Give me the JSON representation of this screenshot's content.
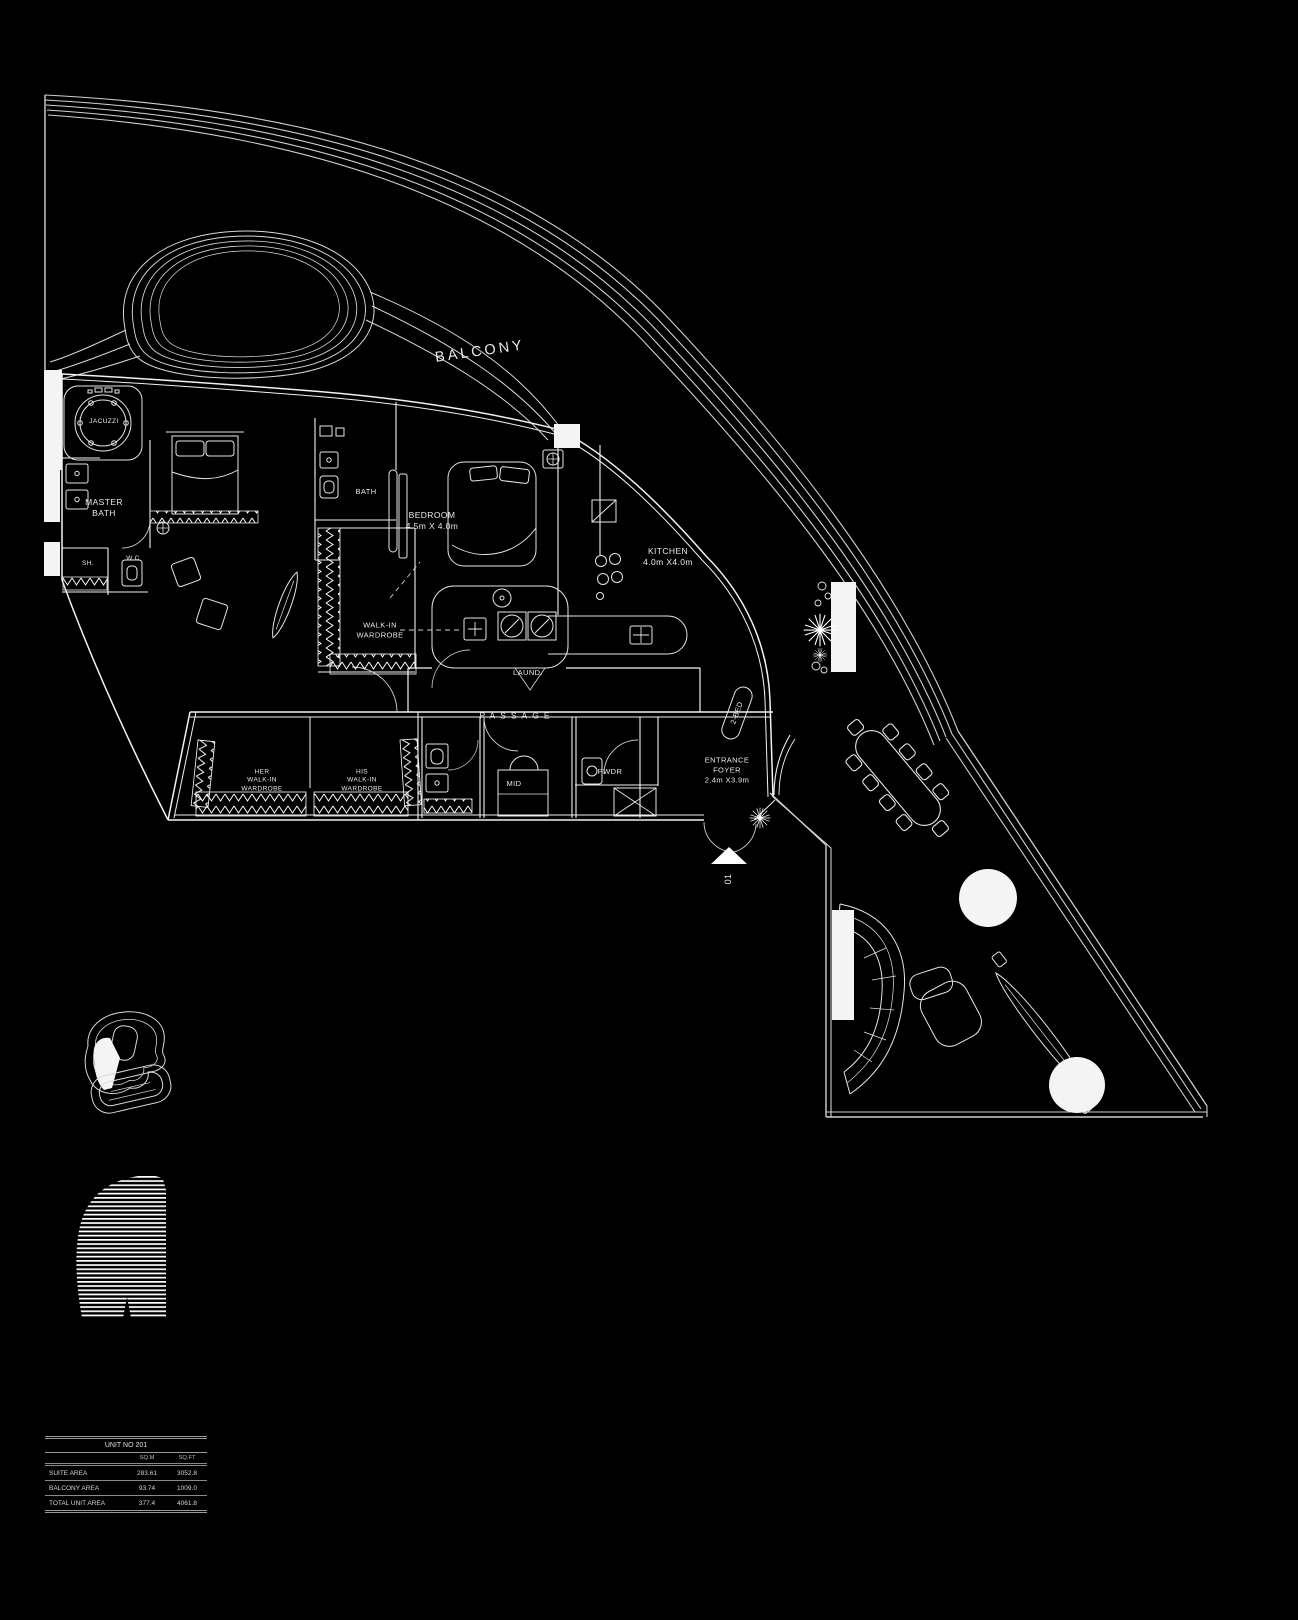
{
  "labels": {
    "balcony": "BALCONY",
    "jacuzzi": "JACUZZI",
    "master_bath_1": "MASTER",
    "master_bath_2": "BATH",
    "shower": "SH.",
    "wc": "W.C",
    "bath": "BATH",
    "bedroom_name": "BEDROOM",
    "bedroom_dims": "4.5m X 4.0m",
    "kitchen_name": "KITCHEN",
    "kitchen_dims": "4.0m X4.0m",
    "walkin_1": "WALK-IN",
    "walkin_2": "WARDROBE",
    "laundry": "LAUND.",
    "passage": "PASSAGE",
    "her_1": "HER",
    "her_2": "WALK-IN",
    "her_3": "WARDROBE",
    "his_1": "HIS",
    "his_2": "WALK-IN",
    "his_3": "WARDROBE",
    "mid": "MID",
    "powder": "PWDR",
    "unit_tag": "2-BED",
    "foyer_1": "ENTRANCE",
    "foyer_2": "FOYER",
    "foyer_dims": "2.4m X3.9m",
    "entry_number": "01"
  },
  "area_table": {
    "title": "UNIT NO 201",
    "col_headers": [
      "SQ.M",
      "SQ.FT"
    ],
    "rows": [
      {
        "label": "SUITE AREA",
        "sqm": "283.61",
        "sqft": "3052.8"
      },
      {
        "label": "BALCONY AREA",
        "sqm": "93.74",
        "sqft": "1009.0"
      },
      {
        "label": "TOTAL UNIT AREA",
        "sqm": "377.4",
        "sqft": "4061.8"
      }
    ]
  },
  "colors": {
    "background": "#000000",
    "line": "#ffffff"
  }
}
